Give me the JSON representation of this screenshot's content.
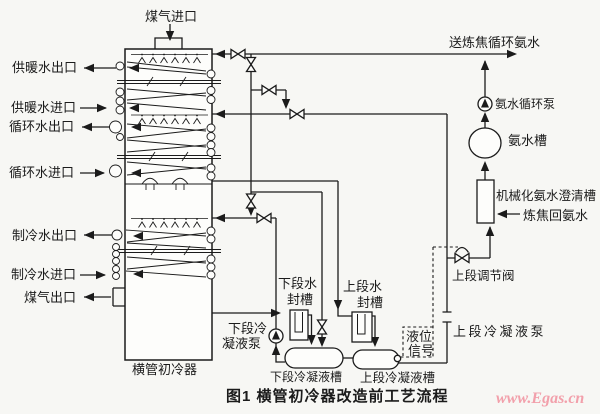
{
  "figure_caption": "图1  横管初冷器改造前工艺流程",
  "watermark": "www.Egas.cn",
  "colors": {
    "line": "#1b1b1b",
    "watermark_pink": "#f2a0ab",
    "background": "#f7f7f4"
  },
  "labels": {
    "gas_inlet": "煤气进口",
    "to_coking_circulating_ammonia": "送炼焦循环氨水",
    "heating_water_outlet": "供暖水出口",
    "heating_water_inlet": "供暖水进口",
    "circulating_water_outlet": "循环水出口",
    "circulating_water_inlet": "循环水进口",
    "chilled_water_outlet": "制冷水出口",
    "chilled_water_inlet": "制冷水进口",
    "gas_outlet": "煤气出口",
    "cooler": "横管初冷器",
    "ammonia_circulating_pump": "氨水循环泵",
    "ammonia_tank": "氨水槽",
    "mechanized_ammonia_clarifier": "机械化氨水澄清槽",
    "coking_return_ammonia": "炼焦回氨水",
    "upper_control_valve": "上段调节阀",
    "upper_condensate_pump": "上段冷凝液泵",
    "level_signal_l1": "液位",
    "level_signal_l2": "信号",
    "lower_seal_tank_l1": "下段水",
    "lower_seal_tank_l2": "封槽",
    "upper_seal_tank_l1": "上段水",
    "upper_seal_tank_l2": "封槽",
    "lower_condensate_pump_l1": "下段冷",
    "lower_condensate_pump_l2": "凝液泵",
    "lower_condensate_tank": "下段冷凝液槽",
    "upper_condensate_tank": "上段冷凝液槽"
  }
}
